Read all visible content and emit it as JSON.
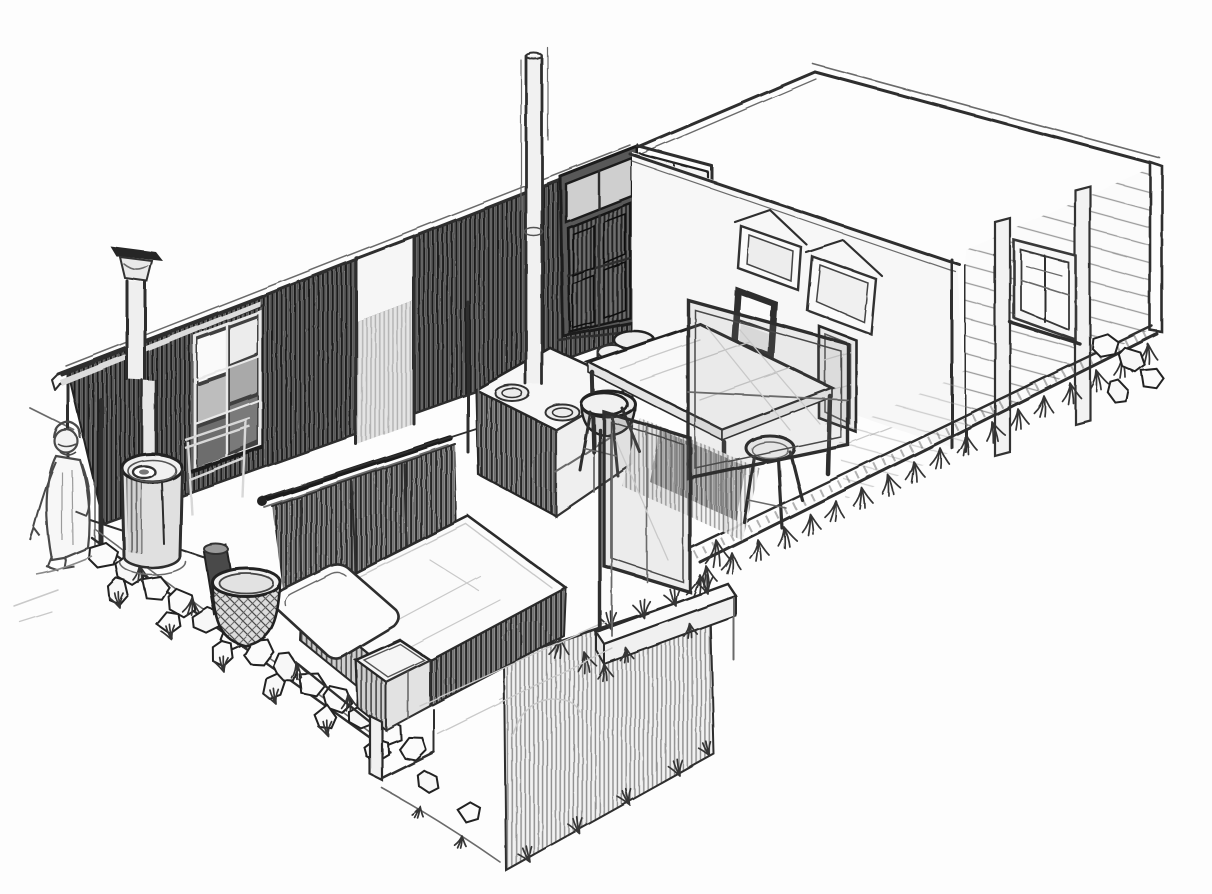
{
  "scene": {
    "medium": "graphite pencil sketch on white paper",
    "view": "cutaway isometric of a one-room timber cabin",
    "elements": [
      {
        "name": "back-wall",
        "desc": "dark hatched rear wall with window and open doorway"
      },
      {
        "name": "entry-doors",
        "desc": "double doors with transom, right leaf open"
      },
      {
        "name": "partition-wall",
        "desc": "white partition with two pediment frames, window and doorway"
      },
      {
        "name": "right-wall",
        "desc": "clapboard siding wall with window and corner trim"
      },
      {
        "name": "chimney",
        "desc": "stovepipe with flared rain cap over porch"
      },
      {
        "name": "barrel-stove",
        "desc": "cylindrical stove on porch"
      },
      {
        "name": "basket",
        "desc": "woven basket beside bed"
      },
      {
        "name": "bed",
        "desc": "bed with mattress, pillow and nightstand on platform"
      },
      {
        "name": "curtain",
        "desc": "dark curtain on rod above bed head"
      },
      {
        "name": "kitchen-stove",
        "desc": "range with two burners and two pots, straight stovepipe"
      },
      {
        "name": "dining-table",
        "desc": "table with three stools"
      },
      {
        "name": "glass-panels",
        "desc": "framed glass partitions around floor opening"
      },
      {
        "name": "earth-cut",
        "desc": "hatched excavated ground section below floor"
      },
      {
        "name": "turf-beam",
        "desc": "floor beam with turf on top"
      },
      {
        "name": "foundation-stones",
        "desc": "rubble stone foundation band"
      },
      {
        "name": "grass",
        "desc": "grass tufts along foundation edges"
      },
      {
        "name": "person-figure",
        "desc": "small robed figure standing at left"
      }
    ]
  },
  "palette": {
    "paper": "#fdfdfd",
    "line": "#2e2e2e",
    "line_dark": "#1e1e1e",
    "line_mid": "#6b6b6b",
    "line_light": "#9c9c9c",
    "construction": "#c9c9c9",
    "hatch_wall": "#808080",
    "hatch_pit": "#f1f1f1"
  }
}
